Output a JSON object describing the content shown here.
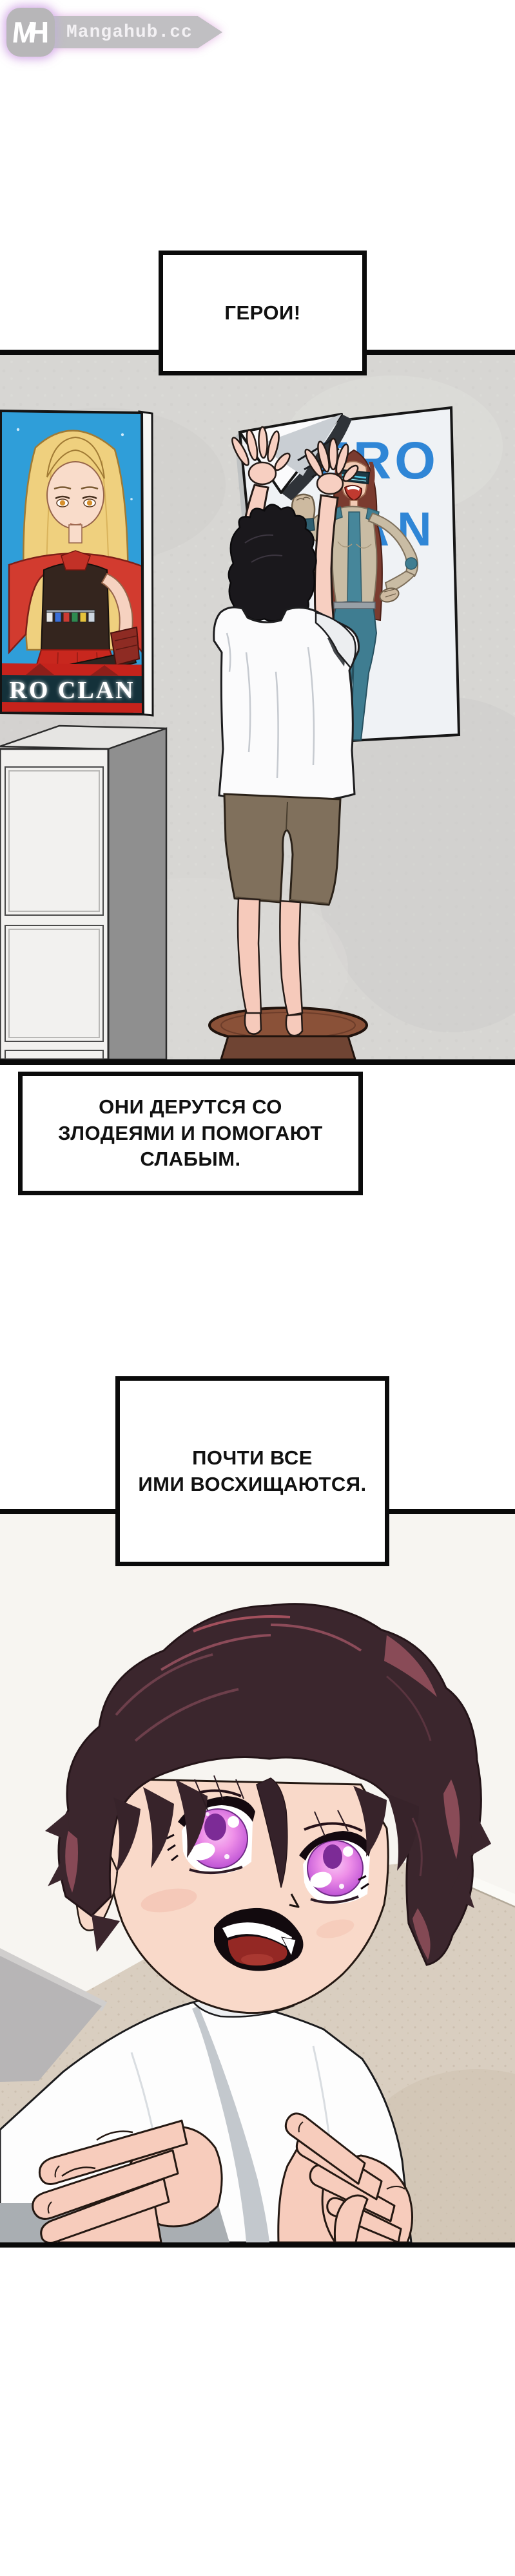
{
  "site": {
    "logo_badge": "MH",
    "logo_badge_m": "M",
    "logo_badge_h": "H",
    "logo_text": "Mangahub.cc"
  },
  "captions": {
    "c1": {
      "text": "ГЕРОИ!"
    },
    "c2": {
      "line1": "ОНИ ДЕРУТСЯ СО",
      "line2": "ЗЛОДЕЯМИ И ПОМОГАЮТ",
      "line3": "СЛАБЫМ."
    },
    "c3": {
      "line1": "ПОЧТИ ВСЕ",
      "line2": "ИМИ ВОСХИЩАЮТСЯ."
    }
  },
  "posters": {
    "left": {
      "title": "RO CLAN"
    },
    "right": {
      "title_line1": "HERO",
      "title_line2": "CLAN"
    }
  },
  "colors": {
    "caption_border": "#0b0b0b",
    "poster_left_blue": "#2f9ed9",
    "poster_band_red": "#c5231c",
    "hero_title_blue": "#2f86d6",
    "wall_gray": "#d7d6d3",
    "carpet_beige": "#d9cec0",
    "stool_brown": "#8a5138",
    "hair_dark": "#3b262d",
    "eye_pink": "#ee8fe8",
    "logo_badge_bg": "#b7b6b8",
    "logo_banner_bg": "#c0bfc2"
  }
}
